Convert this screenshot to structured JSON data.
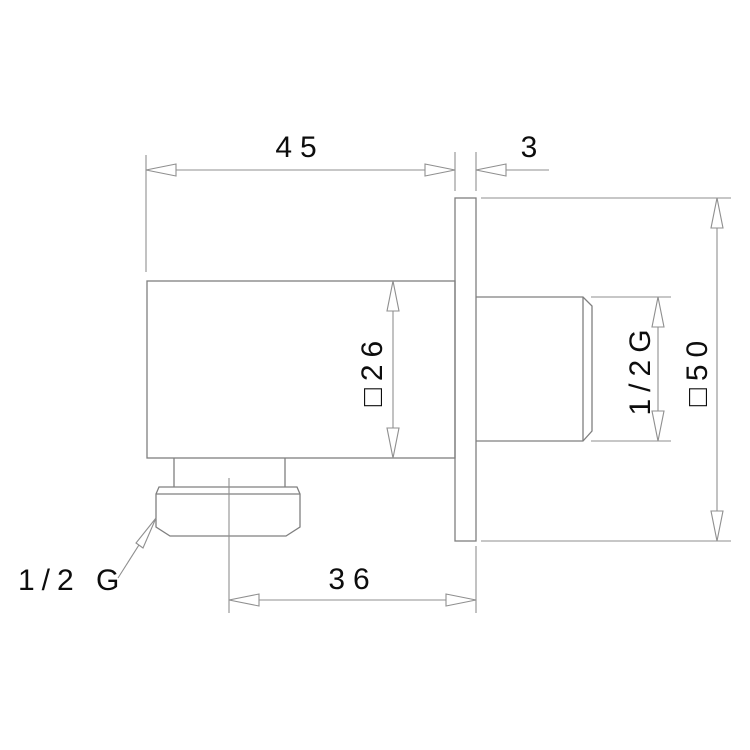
{
  "page": {
    "background_color": "#ffffff",
    "line_color": "#8f8f8f",
    "geometry_color": "#7f7f7f",
    "text_color": "#0d0d0d"
  },
  "drawing": {
    "kind": "technical-dimension-drawing",
    "subject": "wall-mounted square shower outlet elbow, side section view",
    "dimensions": {
      "body_width": {
        "value": "45",
        "meaning": "body length from front face to wall plate"
      },
      "plate_thickness": {
        "value": "3",
        "meaning": "wall plate thickness"
      },
      "body_square": {
        "value": "□26",
        "meaning": "square body section 26"
      },
      "boss_thread": {
        "value": "1/2G",
        "meaning": "rear connection thread height"
      },
      "plate_square": {
        "value": "□50",
        "meaning": "square wall plate section 50"
      },
      "outlet_offset": {
        "value": "36",
        "meaning": "outlet axis distance from wall plate"
      },
      "outlet_thread": {
        "value": "1/2 G",
        "meaning": "bottom outlet thread, leader label"
      }
    }
  }
}
